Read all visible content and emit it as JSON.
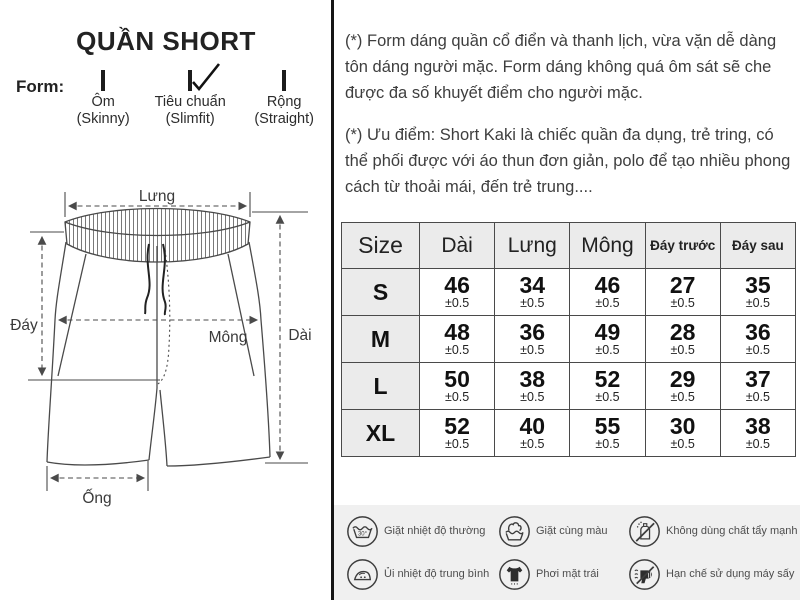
{
  "left": {
    "title": "QUẦN SHORT",
    "form_label": "Form:",
    "form_options": [
      {
        "label": "Ôm",
        "sub": "(Skinny)",
        "checked": false
      },
      {
        "label": "Tiêu chuẩn",
        "sub": "(Slimfit)",
        "checked": true
      },
      {
        "label": "Rộng",
        "sub": "(Straight)",
        "checked": false
      }
    ],
    "diagram_labels": {
      "waist": "Lưng",
      "rise": "Đáy",
      "hip": "Mông",
      "length": "Dài",
      "leg_opening": "Ống"
    }
  },
  "right": {
    "paragraphs": [
      "(*) Form dáng quần cổ điển và thanh lịch, vừa vặn dễ dàng tôn dáng người mặc. Form dáng không quá ôm sát sẽ che được đa số khuyết điểm cho người mặc.",
      "(*) Ưu điểm: Short Kaki là chiếc quần đa dụng, trẻ tring, có thể phối được với áo thun đơn giản, polo để tạo nhiều phong cách từ thoải mái, đến trẻ trung...."
    ]
  },
  "size_table": {
    "headers": [
      "Size",
      "Dài",
      "Lưng",
      "Mông",
      "Đáy trước",
      "Đáy sau"
    ],
    "tolerance": "±0.5",
    "rows": [
      {
        "size": "S",
        "values": [
          "46",
          "34",
          "46",
          "27",
          "35"
        ]
      },
      {
        "size": "M",
        "values": [
          "48",
          "36",
          "49",
          "28",
          "36"
        ]
      },
      {
        "size": "L",
        "values": [
          "50",
          "38",
          "52",
          "29",
          "37"
        ]
      },
      {
        "size": "XL",
        "values": [
          "52",
          "40",
          "55",
          "30",
          "38"
        ]
      }
    ]
  },
  "care": {
    "items": [
      {
        "icon": "wash-temp-icon",
        "label": "Giặt nhiệt độ thường"
      },
      {
        "icon": "wash-same-color-icon",
        "label": "Giặt cùng màu"
      },
      {
        "icon": "no-bleach-icon",
        "label": "Không dùng chất tẩy mạnh"
      },
      {
        "icon": "iron-medium-icon",
        "label": "Ủi nhiệt độ trung bình"
      },
      {
        "icon": "dry-inside-out-icon",
        "label": "Phơi mặt trái"
      },
      {
        "icon": "no-tumble-dry-icon",
        "label": "Hạn chế sử dụng máy sấy"
      }
    ]
  },
  "colors": {
    "divider": "#151515",
    "table_header_bg": "#ebebeb",
    "table_border": "#4a4a4a",
    "care_bg": "#f0f0f0",
    "text": "#3e3e3e"
  }
}
